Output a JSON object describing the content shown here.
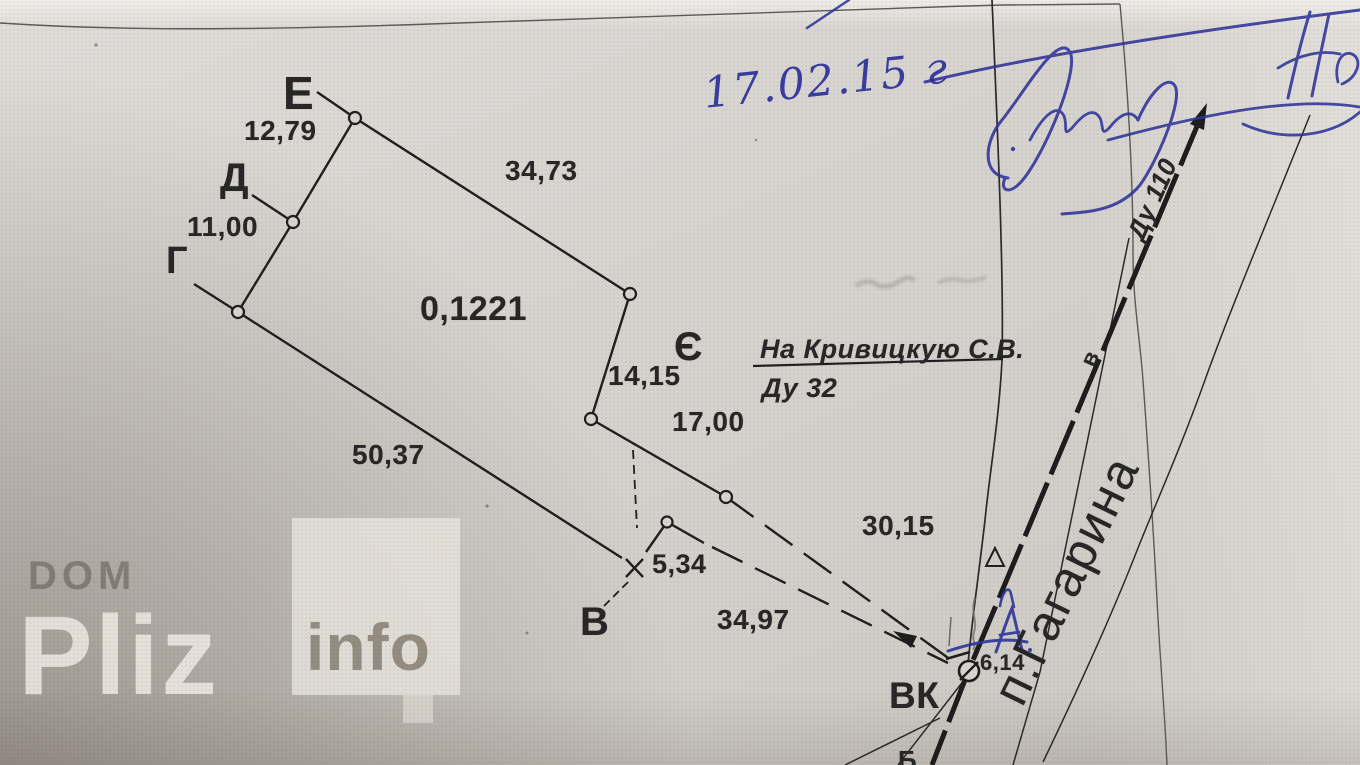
{
  "watermark": {
    "dom": "DOM",
    "pliz": "Pliz",
    "info": "info"
  },
  "handwriting": {
    "date": "17.02.15 г",
    "crossed_letter": "А"
  },
  "plan": {
    "area": "0,1221",
    "points": {
      "g": "Г",
      "d": "Д",
      "e": "Е",
      "ye": "Є",
      "v": "В",
      "vk": "ВК",
      "v_small": "в",
      "partial_bottom": "Б"
    },
    "dims": {
      "d12_79": "12,79",
      "d34_73": "34,73",
      "d11_00": "11,00",
      "d50_37": "50,37",
      "d14_15": "14,15",
      "d17_00": "17,00",
      "d30_15": "30,15",
      "d34_97": "34,97",
      "d5_34": "5,34",
      "d6_14": "6,14"
    },
    "notes": {
      "recipient": "На Кривицкую С.В.",
      "pipe_branch": "Ду 32",
      "pipe_main": "Ду 110",
      "street": "п.Гагарина"
    }
  }
}
